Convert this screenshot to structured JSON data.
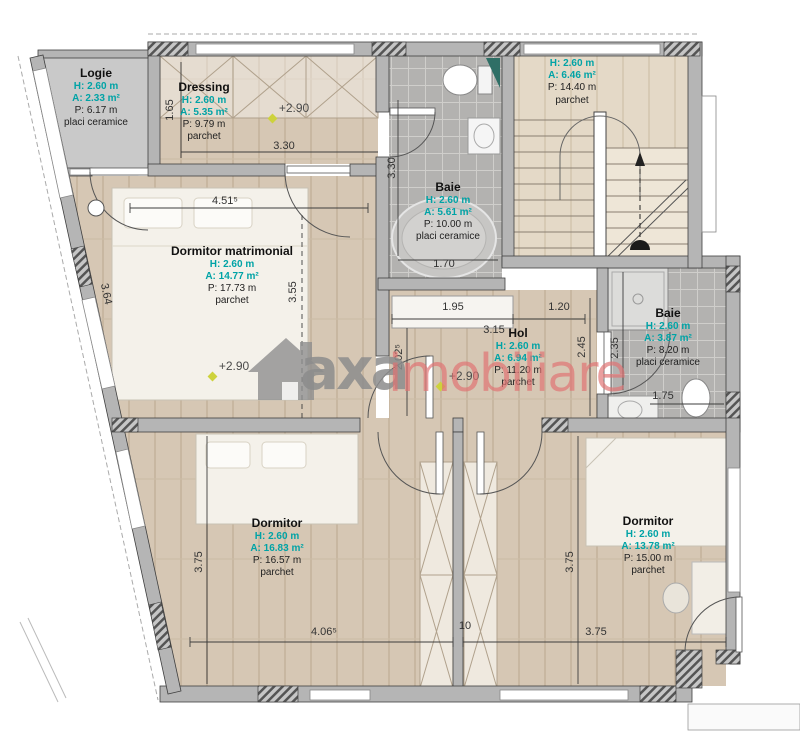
{
  "rooms": [
    {
      "name": "Logie",
      "h": "H: 2.60 m",
      "a": "A: 2.33 m²",
      "p": "P: 6.17 m",
      "floor": "placi ceramice"
    },
    {
      "name": "Dressing",
      "h": "H: 2.60 m",
      "a": "A: 5.35 m²",
      "p": "P: 9.79 m",
      "floor": "parchet"
    },
    {
      "name": "Baie",
      "h": "H: 2.60 m",
      "a": "A: 5.61 m²",
      "p": "P: 10.00 m",
      "floor": "placi ceramice"
    },
    {
      "h": "H: 2.60 m",
      "a": "A: 6.46 m²",
      "p": "P: 14.40 m",
      "floor": "parchet"
    },
    {
      "name": "Dormitor matrimonial",
      "h": "H: 2.60 m",
      "a": "A: 14.77 m²",
      "p": "P: 17.73 m",
      "floor": "parchet"
    },
    {
      "name": "Hol",
      "h": "H: 2.60 m",
      "a": "A: 6.94 m²",
      "p": "P: 11.20 m",
      "floor": "parchet"
    },
    {
      "name": "Baie",
      "h": "H: 2.60 m",
      "a": "A: 3.87 m²",
      "p": "P: 8.20 m",
      "floor": "placi ceramice"
    },
    {
      "name": "Dormitor",
      "h": "H: 2.60 m",
      "a": "A: 16.83 m²",
      "p": "P: 16.57 m",
      "floor": "parchet"
    },
    {
      "name": "Dormitor",
      "h": "H: 2.60 m",
      "a": "A: 13.78 m²",
      "p": "P: 15.00 m",
      "floor": "parchet"
    }
  ],
  "dims": [
    "1.65",
    "3.30",
    "4.51⁵",
    "3.55",
    "3.64",
    "3.30",
    "1.70",
    "1.95",
    "3.15",
    "1.20",
    "2.02⁵",
    "2.45",
    "2.35",
    "1.75",
    "3.75",
    "3.75",
    "4.06⁵",
    "10",
    "3.75"
  ],
  "levels": [
    "+2.90",
    "+2.90",
    "+2.90"
  ],
  "watermark": {
    "brand": "axa",
    "suffix": "imobiliare",
    "icon": "house-icon"
  },
  "colors": {
    "accent_teal": "#00a3a6",
    "wall": "#b5b5b5",
    "tile": "#b3b2b0",
    "wood": "#d6c7b4",
    "watermark_gray": "#8c8c8c",
    "watermark_red": "#e27272",
    "level_marker": "#cdd23c"
  }
}
